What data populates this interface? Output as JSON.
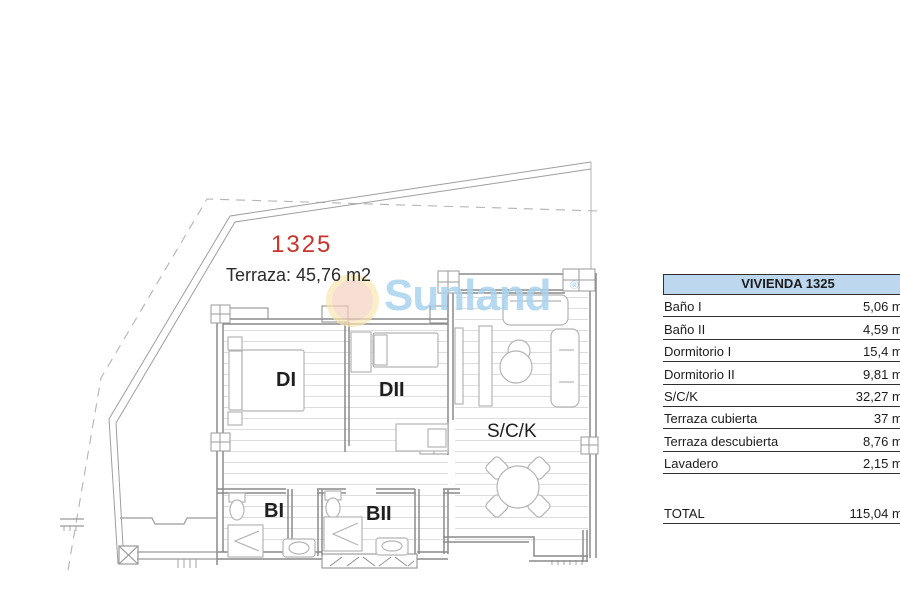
{
  "plan": {
    "unit_number": "1325",
    "terrace_label": "Terraza: 45,76 m2",
    "rooms": {
      "di": "DI",
      "dii": "DII",
      "sck": "S/C/K",
      "bi": "BI",
      "bii": "BII"
    }
  },
  "watermark": {
    "text": "Sunland",
    "reg": "®"
  },
  "table": {
    "header": "VIVIENDA 1325",
    "rows": [
      {
        "label": "Baño I",
        "value": "5,06 m2"
      },
      {
        "label": "Baño II",
        "value": "4,59 m2"
      },
      {
        "label": "Dormitorio I",
        "value": "15,4 m2"
      },
      {
        "label": "Dormitorio II",
        "value": "9,81 m2"
      },
      {
        "label": "S/C/K",
        "value": "32,27 m2"
      },
      {
        "label": "Terraza cubierta",
        "value": "37 m2"
      },
      {
        "label": "Terraza descubierta",
        "value": "8,76 m2"
      },
      {
        "label": "Lavadero",
        "value": "2,15 m2"
      }
    ],
    "total": {
      "label": "TOTAL",
      "value": "115,04 m2"
    }
  },
  "colors": {
    "unit_number_red": "#c9342c",
    "watermark_blue": "#a9d3ee",
    "table_header_blue": "#bdd7ee"
  }
}
